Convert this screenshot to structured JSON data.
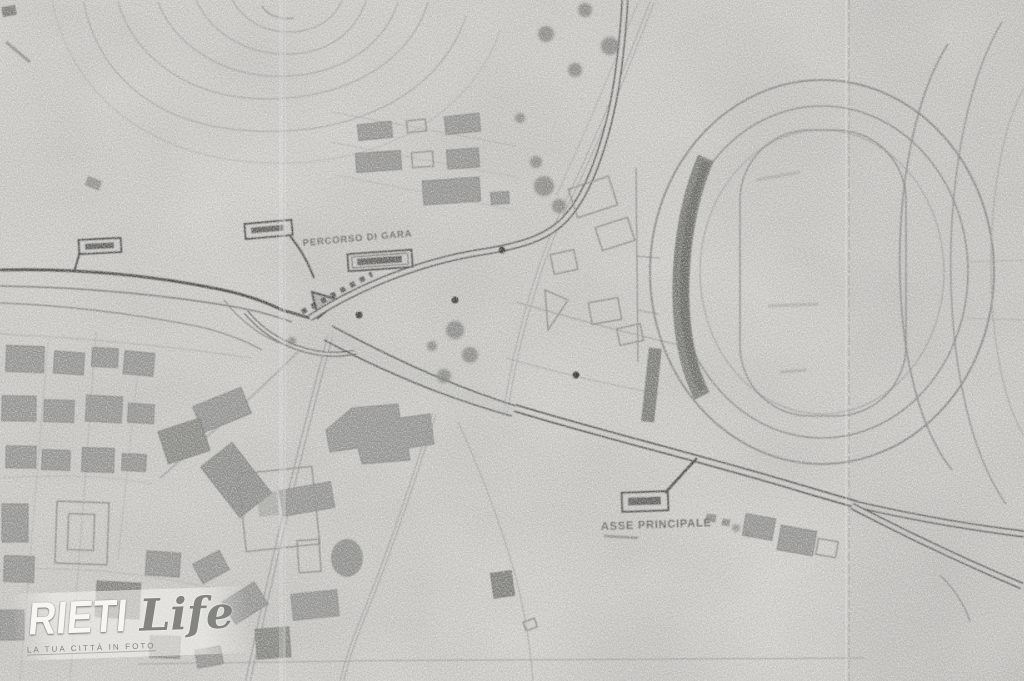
{
  "map": {
    "labels": {
      "route": "PERCORSO DI GARA",
      "main_axis": "ASSE PRINCIPALE"
    },
    "watermark": {
      "brand_primary": "RIETI",
      "brand_secondary": "Life",
      "tagline": "LA TUA CITTÀ IN FOTO"
    },
    "colors": {
      "paper": "#d8d7d3",
      "ink_dark": "#2e2e2c",
      "ink_mid": "#70706e",
      "ink_light": "#a2a2a0",
      "building": "#8b8b89",
      "watermark_text": "#f7f6f2"
    }
  }
}
